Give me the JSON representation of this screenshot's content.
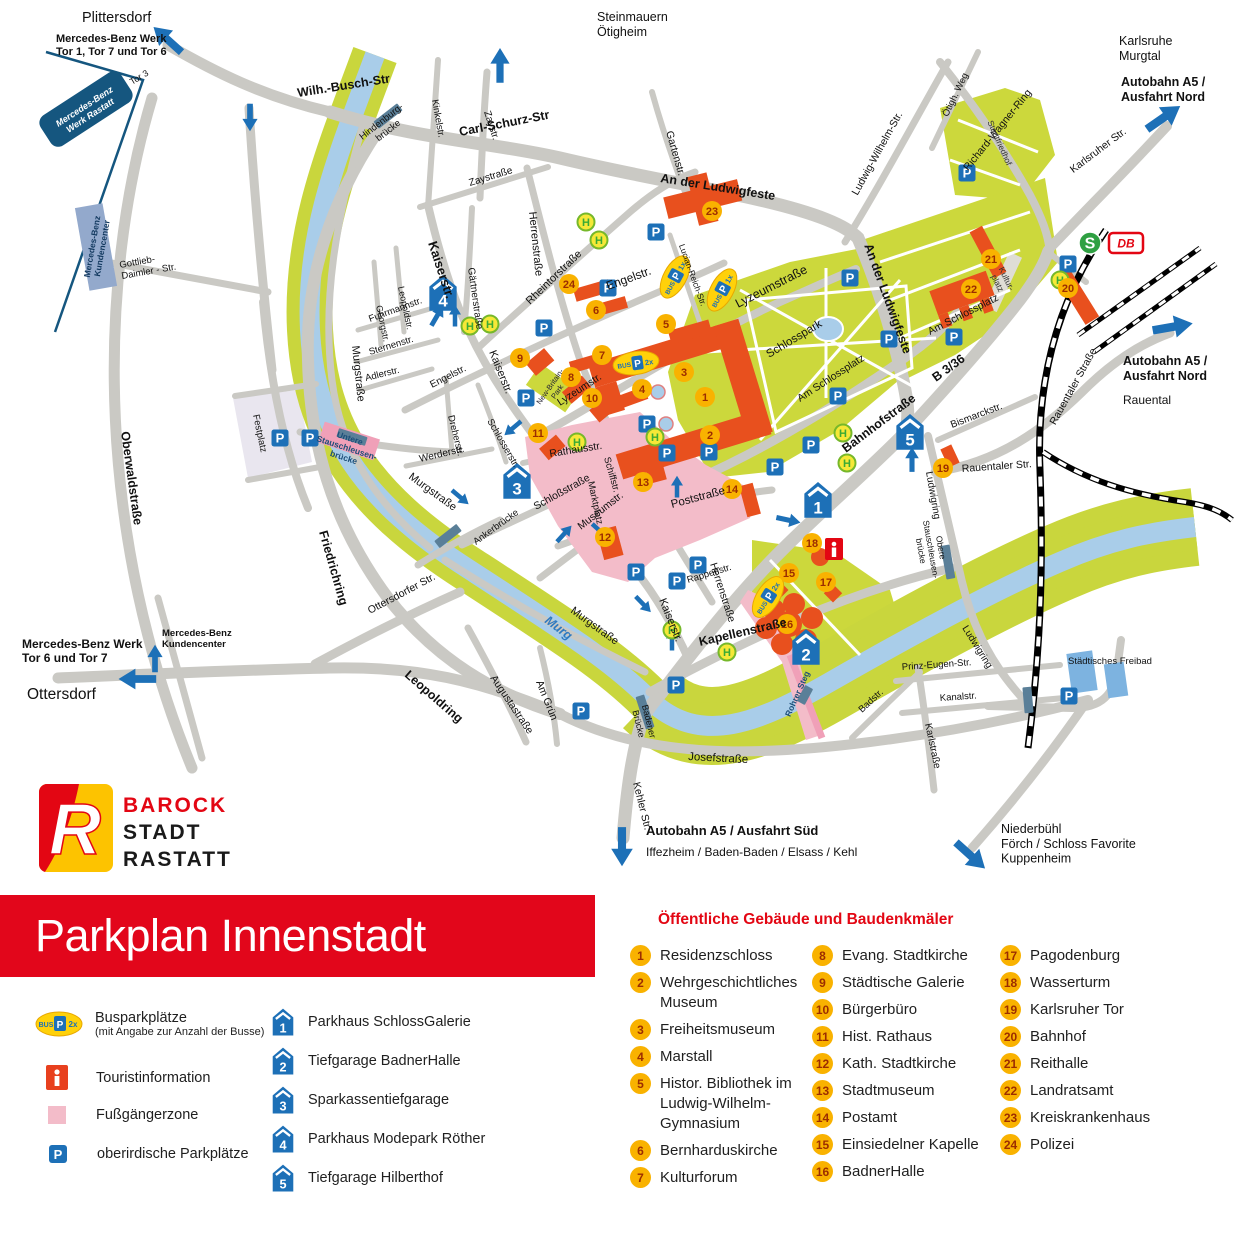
{
  "title": "Parkplan Innenstadt",
  "logo": {
    "initial": "R",
    "top": "BAROCK",
    "middle": "STADT",
    "bottom": "RASTATT"
  },
  "colors": {
    "red": "#e2061b",
    "blue": "#1d70b7",
    "yellow": "#f9b200",
    "orange": "#e8501e",
    "green": "#ccd83c",
    "river": "#a9cde9",
    "pink": "#f3bcc9",
    "road": "#cac9c4"
  },
  "legend": {
    "bus": {
      "label": "Busparkplätze",
      "note": "(mit Angabe zur Anzahl der Busse)",
      "badge": {
        "bus": "BUS",
        "p": "P",
        "count": "2x"
      }
    },
    "info": {
      "label": "Touristinformation"
    },
    "pedestrian": {
      "label": "Fußgängerzone"
    },
    "parking": {
      "label": "oberirdische Parkplätze",
      "letter": "P"
    }
  },
  "garages": [
    {
      "n": "1",
      "label": "Parkhaus SchlossGalerie"
    },
    {
      "n": "2",
      "label": "Tiefgarage BadnerHalle"
    },
    {
      "n": "3",
      "label": "Sparkassentiefgarage"
    },
    {
      "n": "4",
      "label": "Parkhaus Modepark Röther"
    },
    {
      "n": "5",
      "label": "Tiefgarage Hilberthof"
    }
  ],
  "poi": {
    "heading": "Öffentliche Gebäude und Baudenkmäler",
    "columns": [
      7,
      9,
      8
    ],
    "items": [
      {
        "n": "1",
        "label": "Residenzschloss"
      },
      {
        "n": "2",
        "label": "Wehrgeschichtliches Museum"
      },
      {
        "n": "3",
        "label": "Freiheitsmuseum"
      },
      {
        "n": "4",
        "label": "Marstall"
      },
      {
        "n": "5",
        "label": "Histor. Bibliothek im Ludwig-Wilhelm-Gymnasium"
      },
      {
        "n": "6",
        "label": "Bernharduskirche"
      },
      {
        "n": "7",
        "label": "Kulturforum"
      },
      {
        "n": "8",
        "label": "Evang. Stadtkirche"
      },
      {
        "n": "9",
        "label": "Städtische Galerie"
      },
      {
        "n": "10",
        "label": "Bürgerbüro"
      },
      {
        "n": "11",
        "label": "Hist. Rathaus"
      },
      {
        "n": "12",
        "label": "Kath. Stadtkirche"
      },
      {
        "n": "13",
        "label": "Stadtmuseum"
      },
      {
        "n": "14",
        "label": "Postamt"
      },
      {
        "n": "15",
        "label": "Einsiedelner Kapelle"
      },
      {
        "n": "16",
        "label": "BadnerHalle"
      },
      {
        "n": "17",
        "label": "Pagodenburg"
      },
      {
        "n": "18",
        "label": "Wasserturm"
      },
      {
        "n": "19",
        "label": "Karlsruher Tor"
      },
      {
        "n": "20",
        "label": "Bahnhof"
      },
      {
        "n": "21",
        "label": "Reithalle"
      },
      {
        "n": "22",
        "label": "Landratsamt"
      },
      {
        "n": "23",
        "label": "Kreiskrankenhaus"
      },
      {
        "n": "24",
        "label": "Polizei"
      }
    ]
  },
  "map": {
    "label_format": "[text, x, y, rotate, size, bold, color, italic, anchor]",
    "labels": [
      [
        "Wilh.-Busch-Str",
        298,
        97,
        -9,
        12.5,
        1
      ],
      [
        "Carl-Schurz-Str",
        460,
        136,
        -11,
        12.5,
        1
      ],
      [
        "Hindenburg-\nbrücke",
        383,
        124,
        -38,
        9.5,
        0,
        "#111",
        0,
        "middle"
      ],
      [
        "Kinkelstr.",
        432,
        100,
        80,
        9.5
      ],
      [
        "Zaystr.",
        484,
        112,
        72,
        10
      ],
      [
        "Zaystraße",
        470,
        186,
        -17,
        10
      ],
      [
        "Gärtnerstraße",
        468,
        268,
        82,
        10
      ],
      [
        "Herrenstraße",
        529,
        212,
        84,
        11
      ],
      [
        "Rheintorstraße",
        530,
        305,
        -44,
        11
      ],
      [
        "Kaiserstr.",
        428,
        243,
        72,
        13,
        1
      ],
      [
        "Kaiserstr.",
        489,
        352,
        68,
        11
      ],
      [
        "Kaiserstr.",
        659,
        600,
        68,
        11
      ],
      [
        "Leopoldstr.",
        398,
        287,
        78,
        9
      ],
      [
        "Georgstr.",
        376,
        306,
        78,
        9
      ],
      [
        "Fuhrmannstr.",
        370,
        322,
        -20,
        9.5
      ],
      [
        "Sternenstr.",
        370,
        355,
        -17,
        9.5
      ],
      [
        "Adlerstr.",
        366,
        381,
        -14,
        9.5
      ],
      [
        "Engelstr.",
        432,
        388,
        -27,
        10
      ],
      [
        "Engelstr.",
        608,
        290,
        -20,
        12
      ],
      [
        "Dreherstr.",
        448,
        416,
        76,
        9.5
      ],
      [
        "Schlosserstr.",
        487,
        421,
        60,
        9.5
      ],
      [
        "Werderstr.",
        420,
        462,
        -13,
        10
      ],
      [
        "Murgstraße",
        352,
        346,
        84,
        11
      ],
      [
        "Murgstraße",
        408,
        478,
        36,
        11
      ],
      [
        "Murgstraße",
        570,
        612,
        36,
        11
      ],
      [
        "Friedrichring",
        319,
        532,
        74,
        12.5,
        1
      ],
      [
        "Oberwaldstraße",
        121,
        432,
        82,
        12.5,
        1
      ],
      [
        "Leopoldring",
        404,
        676,
        41,
        12.5,
        1
      ],
      [
        "Ottersdorfer Str.",
        370,
        614,
        -28,
        10.5
      ],
      [
        "Augustastraße",
        490,
        678,
        56,
        10.5
      ],
      [
        "Am Grün",
        536,
        682,
        68,
        10.5
      ],
      [
        "Kehler Str.",
        633,
        783,
        76,
        10.5
      ],
      [
        "Badener\nBrücke",
        646,
        722,
        76,
        9,
        0,
        "#111",
        0,
        "middle"
      ],
      [
        "Josefstraße",
        688,
        760,
        3,
        11.5
      ],
      [
        "Kapellenstraße",
        700,
        646,
        -13,
        12.5,
        1
      ],
      [
        "Schloßstraße",
        536,
        510,
        -29,
        10.5
      ],
      [
        "Museumstr.",
        581,
        530,
        -38,
        10.5
      ],
      [
        "Rathausstr.",
        550,
        457,
        -9,
        10.5
      ],
      [
        "Marktplatz",
        588,
        482,
        78,
        9.5
      ],
      [
        "Schiffstr.",
        604,
        458,
        74,
        9.5
      ],
      [
        "Poststraße",
        672,
        508,
        -15,
        11.5
      ],
      [
        "Herrenstraße",
        710,
        564,
        72,
        10.5
      ],
      [
        "Rappenstr.",
        688,
        583,
        -17,
        9.5
      ],
      [
        "Lyzeumstr.",
        560,
        406,
        -33,
        10.5
      ],
      [
        "Lyzeumstraße",
        738,
        308,
        -27,
        12.5
      ],
      [
        "Lucian-Reich-Str.",
        690,
        276,
        70,
        8.5,
        0,
        "#111",
        0,
        "middle"
      ],
      [
        "Gartenstr.",
        666,
        132,
        74,
        10.5
      ],
      [
        "An der Ludwigfeste",
        660,
        182,
        9,
        12.5,
        1
      ],
      [
        "An der Ludwigfeste",
        884,
        300,
        70,
        12.5,
        1,
        "#111",
        0,
        "middle"
      ],
      [
        "Am Schlossplatz",
        800,
        402,
        -33,
        10.5
      ],
      [
        "Am Schlossplatz",
        930,
        335,
        -27,
        10.5
      ],
      [
        "Bahnhofstraße",
        846,
        453,
        -37,
        12.5,
        1
      ],
      [
        "B 3/36",
        936,
        382,
        -36,
        12.5,
        1
      ],
      [
        "Bismarckstr.",
        952,
        428,
        -21,
        10
      ],
      [
        "Ludwigring",
        926,
        472,
        80,
        10
      ],
      [
        "Ludwigring",
        962,
        628,
        58,
        10
      ],
      [
        "Ludwig-Wilhelm-Str.",
        880,
        155,
        -61,
        10.5,
        0,
        "#111",
        0,
        "middle"
      ],
      [
        "Richard-Wagner-Ring",
        1000,
        132,
        -51,
        10.5,
        0,
        "#111",
        0,
        "middle"
      ],
      [
        "Ötigh. Weg",
        958,
        96,
        -64,
        9.5,
        0,
        "#111",
        0,
        "middle"
      ],
      [
        "Stadtfriedhof",
        997,
        144,
        66,
        8.5,
        0,
        "#333",
        0,
        "middle"
      ],
      [
        "Karlsruher Str.",
        1100,
        153,
        -37,
        10.5,
        0,
        "#111",
        0,
        "middle"
      ],
      [
        "Rauentaler Straße",
        1076,
        388,
        -61,
        10.5,
        0,
        "#111",
        0,
        "middle"
      ],
      [
        "Rauentaler Str.",
        962,
        472,
        -4,
        10.5
      ],
      [
        "Prinz-Eugen-Str.",
        902,
        670,
        -4,
        9.5
      ],
      [
        "Kanalstr.",
        940,
        701,
        -4,
        9.5
      ],
      [
        "Badstr.",
        862,
        713,
        -43,
        9.5
      ],
      [
        "Karlstraße",
        925,
        724,
        78,
        10
      ],
      [
        "Gottlieb-\nDaimler - Str.",
        120,
        268,
        -10,
        9.5
      ],
      [
        "Festplatz",
        257,
        434,
        78,
        9.5,
        0,
        "#111",
        0,
        "middle"
      ],
      [
        "Kultur-\nplatz",
        1004,
        280,
        64,
        8.5,
        0,
        "#333",
        0,
        "middle"
      ],
      [
        "Schlosspark",
        769,
        358,
        -31,
        11.5
      ],
      [
        "New-Britain-\nPark",
        552,
        388,
        -55,
        7.5,
        0,
        "#223",
        0,
        "middle"
      ],
      [
        "Murg",
        544,
        622,
        37,
        12.5,
        1,
        "#2e7ac1",
        1
      ],
      [
        "Tor 3",
        132,
        85,
        -31,
        9
      ],
      [
        "Ankerbrücke",
        476,
        545,
        -36,
        9.5
      ],
      [
        "Obere\nStauschleusen-\nbrücke",
        938,
        548,
        80,
        8.5,
        0,
        "#111",
        0,
        "middle"
      ],
      [
        "Untere\nStauschleusen-\nbrücke",
        349,
        441,
        18,
        8.5,
        1,
        "#1c4e79",
        0,
        "middle"
      ],
      [
        "Rohrer Steg",
        800,
        695,
        -66,
        8.5,
        1,
        "#1c4e79",
        0,
        "middle"
      ],
      [
        "Städtisches Freibad",
        1068,
        664,
        0,
        9.5
      ],
      [
        "Plittersdorf",
        82,
        22,
        0,
        14.5
      ],
      [
        "Mercedes-Benz Werk\nTor 1, Tor 7 und Tor 6",
        56,
        42,
        0,
        11,
        1
      ],
      [
        "Steinmauern\nÖtigheim",
        597,
        21,
        0,
        12.5
      ],
      [
        "Karlsruhe\nMurgtal",
        1119,
        45,
        0,
        12.5
      ],
      [
        "Autobahn A5 /\nAusfahrt Nord",
        1121,
        86,
        0,
        12.5,
        1
      ],
      [
        "Autobahn A5 /\nAusfahrt Nord",
        1123,
        365,
        0,
        12.5,
        1
      ],
      [
        "Rauental",
        1123,
        404,
        0,
        12
      ],
      [
        "Mercedes-Benz Werk\nTor 6 und Tor 7",
        22,
        648,
        0,
        12,
        1
      ],
      [
        "Ottersdorf",
        27,
        699,
        0,
        15.5
      ],
      [
        "Mercedes-Benz\nKundencenter",
        162,
        636,
        0,
        9.5,
        1
      ],
      [
        "Autobahn A5 / Ausfahrt Süd",
        646,
        835,
        0,
        13,
        1
      ],
      [
        "Iffezheim / Baden-Baden / Elsass / Kehl",
        646,
        856,
        0,
        12
      ],
      [
        "Niederbühl\nFörch / Schloss Favorite\nKuppenheim",
        1001,
        833,
        0,
        12.5
      ],
      [
        "Mercedes-Benz\nWerk Rastatt",
        86,
        109,
        -33,
        9,
        1,
        "#fff",
        1,
        "middle"
      ],
      [
        "Mercedes-Benz\nKundencenter",
        95,
        247,
        -80,
        8.5,
        1,
        "#12395f",
        0,
        "middle"
      ]
    ],
    "p_markers": [
      [
        967,
        173
      ],
      [
        656,
        232
      ],
      [
        608,
        288
      ],
      [
        544,
        328
      ],
      [
        526,
        398
      ],
      [
        280,
        438
      ],
      [
        310,
        438
      ],
      [
        636,
        572
      ],
      [
        677,
        581
      ],
      [
        698,
        565
      ],
      [
        581,
        711
      ],
      [
        676,
        685
      ],
      [
        647,
        424
      ],
      [
        667,
        453
      ],
      [
        709,
        452
      ],
      [
        775,
        467
      ],
      [
        811,
        445
      ],
      [
        838,
        396
      ],
      [
        850,
        278
      ],
      [
        889,
        339
      ],
      [
        954,
        337
      ],
      [
        1068,
        264
      ],
      [
        1069,
        696
      ]
    ],
    "h_markers": [
      [
        586,
        222
      ],
      [
        599,
        240
      ],
      [
        470,
        326
      ],
      [
        490,
        324
      ],
      [
        577,
        442
      ],
      [
        655,
        437
      ],
      [
        843,
        433
      ],
      [
        847,
        463
      ],
      [
        672,
        630
      ],
      [
        727,
        652
      ],
      [
        1060,
        280
      ]
    ],
    "poi_markers": [
      [
        1,
        705,
        397
      ],
      [
        2,
        710,
        435
      ],
      [
        3,
        684,
        372
      ],
      [
        4,
        642,
        389
      ],
      [
        5,
        666,
        324
      ],
      [
        6,
        596,
        310
      ],
      [
        7,
        602,
        355
      ],
      [
        8,
        571,
        377
      ],
      [
        9,
        520,
        358
      ],
      [
        10,
        592,
        398
      ],
      [
        11,
        538,
        433
      ],
      [
        12,
        605,
        537
      ],
      [
        13,
        643,
        482
      ],
      [
        14,
        732,
        489
      ],
      [
        15,
        789,
        573
      ],
      [
        16,
        787,
        624
      ],
      [
        17,
        826,
        582
      ],
      [
        18,
        812,
        543
      ],
      [
        19,
        943,
        468
      ],
      [
        20,
        1068,
        288
      ],
      [
        21,
        991,
        259
      ],
      [
        22,
        971,
        289
      ],
      [
        23,
        712,
        211
      ],
      [
        24,
        569,
        284
      ]
    ],
    "garage_markers": [
      [
        1,
        818,
        502
      ],
      [
        2,
        806,
        649
      ],
      [
        3,
        517,
        483
      ],
      [
        4,
        443,
        295
      ],
      [
        5,
        910,
        434
      ]
    ],
    "bus_markers": [
      [
        675,
        277,
        -62,
        "1x"
      ],
      [
        722,
        290,
        -62,
        "1x"
      ],
      [
        636,
        363,
        -8,
        "2x"
      ],
      [
        768,
        597,
        -58,
        "2x"
      ]
    ],
    "arrows": [
      [
        168,
        40,
        -138,
        1.3
      ],
      [
        500,
        66,
        -90,
        1.2
      ],
      [
        1163,
        118,
        -35,
        1.4
      ],
      [
        1172,
        327,
        -10,
        1.4
      ],
      [
        138,
        679,
        180,
        1.3
      ],
      [
        155,
        659,
        -90,
        0.95
      ],
      [
        622,
        846,
        90,
        1.35
      ],
      [
        970,
        855,
        42,
        1.35
      ],
      [
        250,
        117,
        90,
        0.95
      ],
      [
        437,
        316,
        -60,
        0.8
      ],
      [
        912,
        460,
        -90,
        0.85
      ],
      [
        788,
        520,
        12,
        0.85
      ],
      [
        455,
        316,
        -90,
        0.75
      ],
      [
        513,
        428,
        140,
        0.75
      ],
      [
        600,
        531,
        42,
        0.75
      ],
      [
        643,
        604,
        46,
        0.75
      ],
      [
        672,
        640,
        -90,
        0.75
      ],
      [
        677,
        487,
        -90,
        0.75
      ],
      [
        564,
        534,
        -48,
        0.75
      ],
      [
        460,
        497,
        40,
        0.75
      ]
    ],
    "bridges": [
      [
        388,
        116,
        -38,
        30
      ],
      [
        352,
        437,
        18,
        30
      ],
      [
        448,
        536,
        -38,
        28
      ],
      [
        645,
        712,
        72,
        34
      ],
      [
        948,
        562,
        80,
        34
      ],
      [
        805,
        695,
        -62,
        18
      ],
      [
        1028,
        700,
        85,
        26
      ]
    ],
    "special": {
      "info": [
        834,
        549
      ],
      "sbahn": [
        1090,
        243
      ],
      "db": [
        1126,
        243
      ],
      "sbahn_letter": "S",
      "db_letters": "DB",
      "info_letter": "i"
    }
  }
}
